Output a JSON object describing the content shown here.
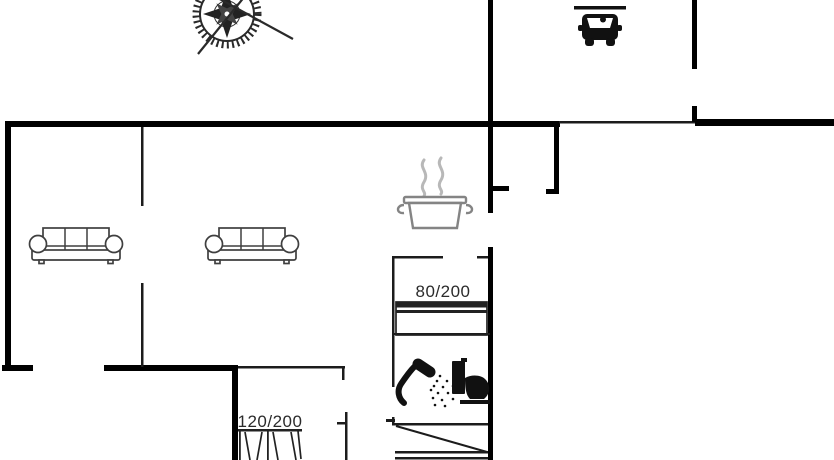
{
  "plan": {
    "bed_labels": {
      "single": "80/200",
      "double": "120/200"
    }
  },
  "colors": {
    "wall": "#000000",
    "wall-thin": "#1c1c1c",
    "furniture": "#3f3f3f",
    "icon-black": "#111111",
    "pot-gray": "#848484",
    "steam-gray": "#b8b8b8",
    "label": "#2b2b2b",
    "bg": "#ffffff"
  },
  "icons": {
    "compass": "compass-rose-icon",
    "car": "carport-car-icon",
    "pot": "cooking-pot-icon",
    "sofa": "sofa-icon",
    "shower": "shower-icon",
    "toilet": "toilet-icon",
    "bed_single": "single-bed-symbol",
    "bed_double": "double-bed-symbol",
    "stairs": "stairs-symbol"
  }
}
